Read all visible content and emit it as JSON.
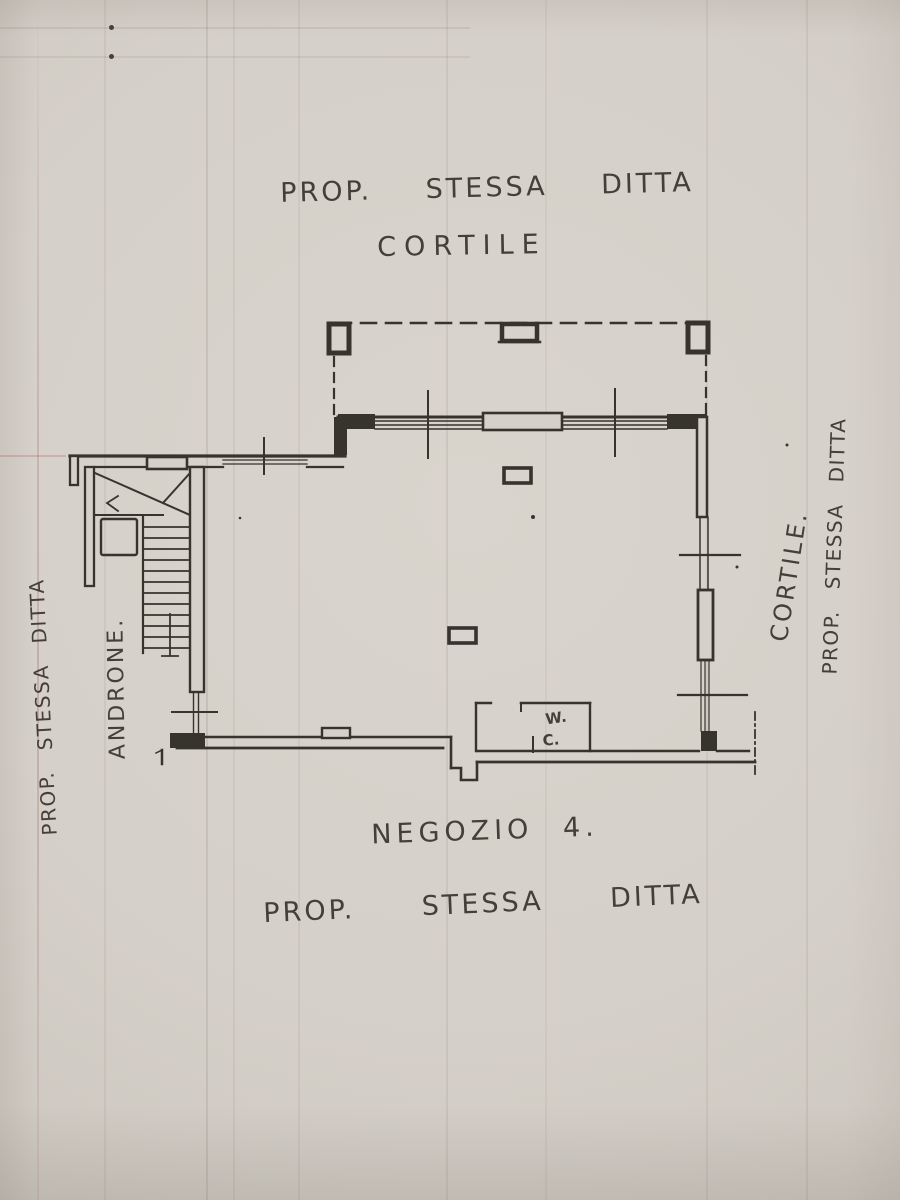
{
  "document": {
    "kind": "scanned floor plan",
    "labels": {
      "top_property": "PROP. STESSA DITTA",
      "courtyard_top": "CORTILE",
      "left_property": "PROP. STESSA DITTA",
      "hallway": "ANDRONE.",
      "courtyard_right": "CORTILE.",
      "right_property": "PROP. STESSA DITTA",
      "room_name": "NEGOZIO 4.",
      "bottom_property": "PROP. STESSA DITTA",
      "wc_top": "W.",
      "wc_bottom": "C."
    },
    "colors": {
      "ink": "#37332d",
      "paper": "#d5d0c9"
    }
  }
}
